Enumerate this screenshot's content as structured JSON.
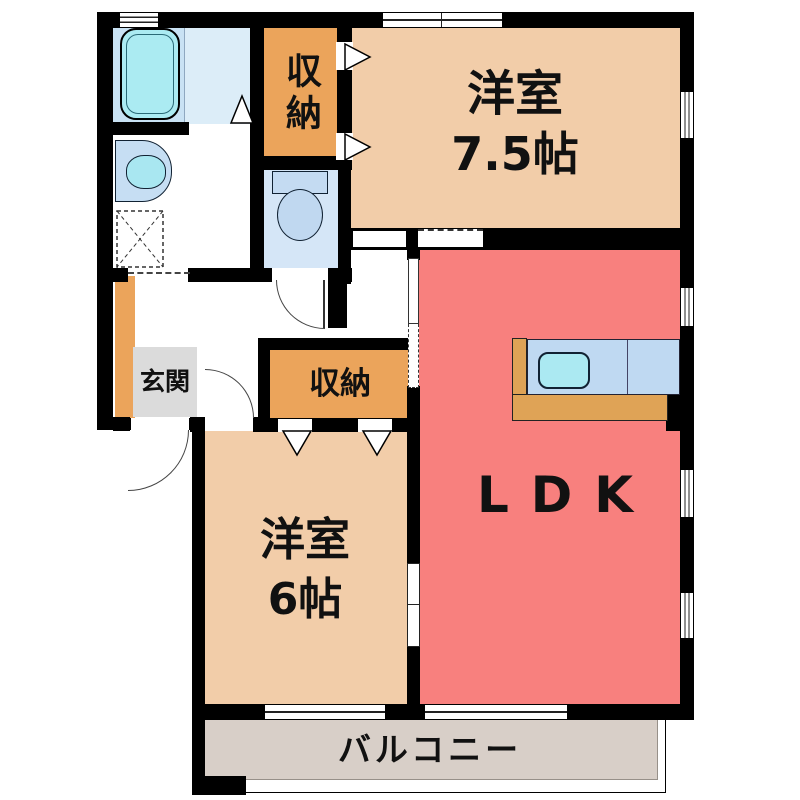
{
  "plan_title": "2LDK apartment floor plan",
  "rooms": {
    "western_room_75": {
      "name": "洋室",
      "size": "7.5帖"
    },
    "western_room_6": {
      "name": "洋室",
      "size": "6帖"
    },
    "ldk": {
      "name": "LDK"
    },
    "closet_top": {
      "name": "収納"
    },
    "closet_mid": {
      "name": "収納"
    },
    "entrance": {
      "name": "玄関"
    },
    "balcony": {
      "name": "バルコニー"
    }
  },
  "fixtures": [
    "bathtub",
    "washbasin",
    "washing-machine-pan",
    "toilet",
    "kitchen-counter",
    "kitchen-sink"
  ],
  "colors": {
    "room_peach": "#F2CDA9",
    "ldk_red": "#F8807E",
    "closet_orange": "#EBA45B",
    "balcony_gray": "#D8CFC8",
    "bath_floor_blue": "#C9E2F4",
    "bath_floor_light": "#DCEDF8",
    "toilet_floor_blue": "#D5E6F7",
    "fixture_cyan": "#ABEBF2",
    "counter_blue": "#BFD9F2",
    "wood_counter": "#DFA356",
    "entrance_gray": "#DBDBDB",
    "wall_black": "#000000"
  }
}
